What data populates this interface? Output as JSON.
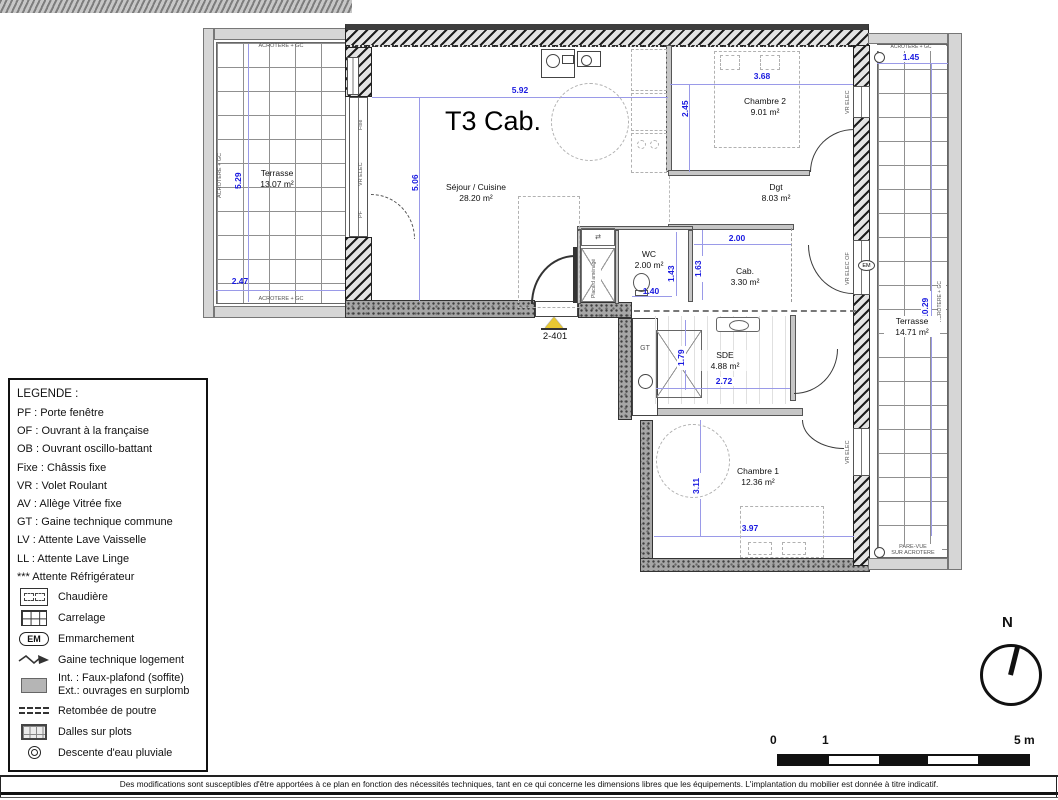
{
  "title": "T3 Cab.",
  "unit_marker": "2-401",
  "rooms": {
    "sejour": {
      "name": "Séjour / Cuisine",
      "area": "28.20 m²"
    },
    "chambre2": {
      "name": "Chambre 2",
      "area": "9.01 m²"
    },
    "dgt": {
      "name": "Dgt",
      "area": "8.03 m²"
    },
    "wc": {
      "name": "WC",
      "area": "2.00 m²"
    },
    "cab": {
      "name": "Cab.",
      "area": "3.30 m²"
    },
    "sde": {
      "name": "SDE",
      "area": "4.88 m²"
    },
    "chambre1": {
      "name": "Chambre 1",
      "area": "12.36 m²"
    },
    "terrasse_ouest": {
      "name": "Terrasse",
      "area": "13.07 m²"
    },
    "terrasse_est": {
      "name": "Terrasse",
      "area": "14.71 m²"
    }
  },
  "dims": {
    "sejour_w": "5.92",
    "sejour_h": "5.06",
    "ch2_w": "3.68",
    "ch2_h": "2.45",
    "wc_h": "1.43",
    "wc_w": "1.40",
    "cab_w": "2.00",
    "cab_h": "1.63",
    "sde_h": "1.79",
    "sde_w": "2.72",
    "ch1_h": "3.11",
    "ch1_w": "3.97",
    "tw_h": "5.29",
    "tw_w": "2.47",
    "te_w": "1.45",
    "te_h": "10.29"
  },
  "labels": {
    "acrotere": "ACROTERE + GC",
    "pare_vue_1": "PARE-VUE",
    "pare_vue_2": "SUR ACROTERE",
    "gt": "GT",
    "placard": "Placard aménagé",
    "fixe": "Fixe",
    "vr_elec": "VR ELEC",
    "vr_elec_of": "VR ELEC OF",
    "pf": "PF",
    "em": "EM"
  },
  "legend": {
    "title": "LEGENDE :",
    "items": [
      "PF : Porte fenêtre",
      "OF : Ouvrant à la française",
      "OB : Ouvrant oscillo-battant",
      "Fixe : Châssis fixe",
      "VR : Volet Roulant",
      "AV : Allège Vitrée fixe",
      "GT : Gaine technique commune",
      "LV : Attente Lave Vaisselle",
      "LL : Attente Lave Linge",
      "*** Attente Réfrigérateur"
    ],
    "symbols": [
      {
        "icon": "boiler-icon",
        "label": "Chaudière"
      },
      {
        "icon": "tiling-icon",
        "label": "Carrelage"
      },
      {
        "icon": "step-icon",
        "badge": "EM",
        "label": "Emmarchement"
      },
      {
        "icon": "duct-icon",
        "label": "Gaine technique logement"
      },
      {
        "icon": "soffit-icon",
        "label": "Int. : Faux-plafond (soffite)",
        "label2": "Ext.: ouvrages en surplomb"
      },
      {
        "icon": "beam-icon",
        "label": "Retombée de poutre"
      },
      {
        "icon": "slabs-icon",
        "label": "Dalles sur plots"
      },
      {
        "icon": "downpipe-icon",
        "label": "Descente d'eau pluviale"
      }
    ]
  },
  "scale_bar": {
    "tick0": "0",
    "tick1": "1",
    "tick5": "5 m"
  },
  "compass": {
    "label": "N"
  },
  "footer": "Des modifications sont susceptibles d'être apportées à ce plan en fonction des nécessités techniques, tant en ce qui concerne les dimensions libres que les équipements. L'implantation du mobilier est donnée à titre indicatif."
}
